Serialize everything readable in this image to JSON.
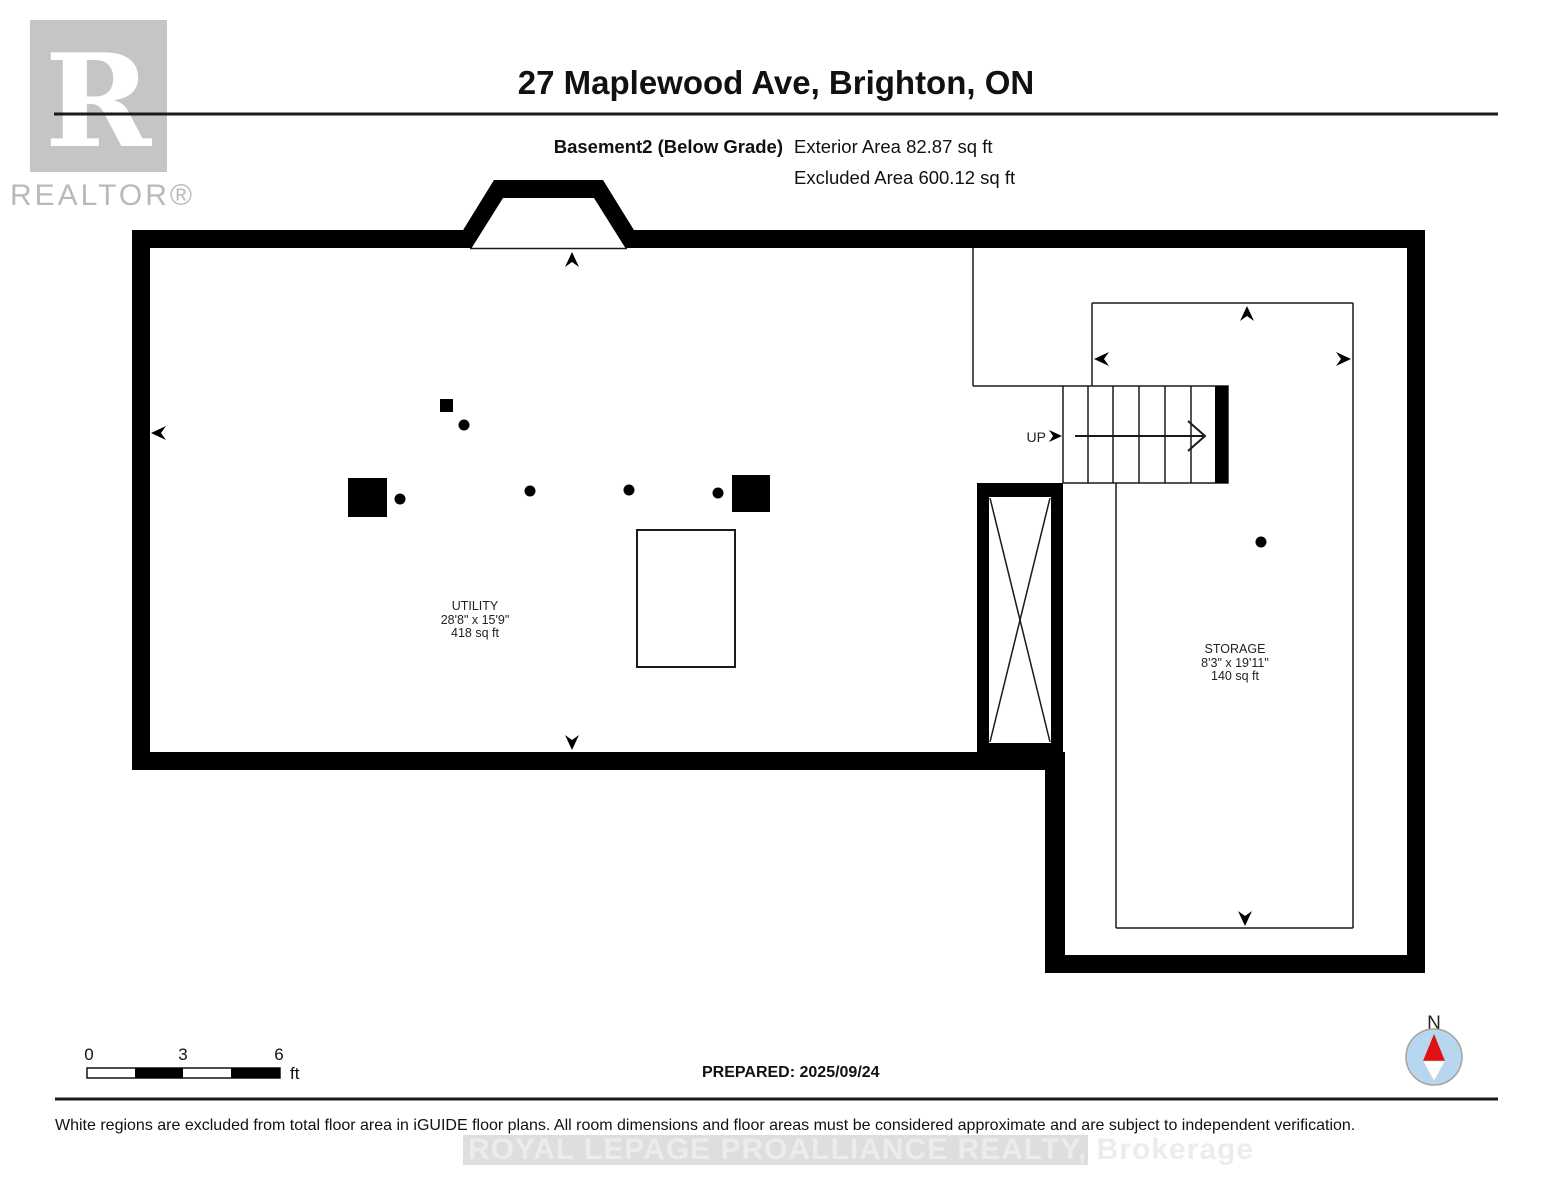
{
  "header": {
    "logo_r": "R",
    "realtor_text": "REALTOR®",
    "title": "27 Maplewood Ave, Brighton, ON",
    "floor_label": "Basement2 (Below Grade)",
    "exterior_area": "Exterior Area 82.87 sq ft",
    "excluded_area": "Excluded Area 600.12 sq ft"
  },
  "rooms": [
    {
      "name": "UTILITY",
      "dimensions": "28'8\" x 15'9\"",
      "area": "418 sq ft"
    },
    {
      "name": "STORAGE",
      "dimensions": "8'3\" x 19'11\"",
      "area": "140 sq ft"
    }
  ],
  "stairs": {
    "label": "UP"
  },
  "scale_bar": {
    "tick_0": "0",
    "tick_3": "3",
    "tick_6": "6",
    "unit": "ft"
  },
  "compass": {
    "label": "N"
  },
  "footer": {
    "prepared": "PREPARED: 2025/09/24",
    "disclaimer": "White regions are excluded from total floor area in iGUIDE floor plans. All room dimensions and floor areas must be considered approximate and are subject to independent verification.",
    "watermark": "ROYAL LEPAGE PROALLIANCE REALTY, Brokerage"
  },
  "colors": {
    "wall": "#000000",
    "logo_gray": "#c5c5c5",
    "realtor_text_gray": "#b9b9b9",
    "watermark_band": "#dedede",
    "watermark_text": "#ececec",
    "compass_fill": "#b7d7f0",
    "compass_ring": "#a9a396",
    "compass_needle_red": "#e01111"
  }
}
